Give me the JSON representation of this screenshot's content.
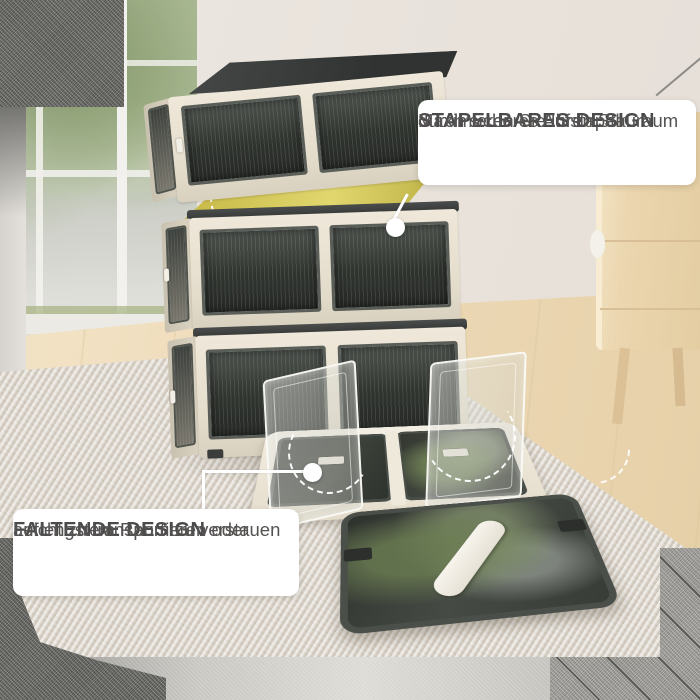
{
  "annotations": {
    "stackable": {
      "title": "STAPELBARES DESIGN",
      "line1": "Maximieren Sie Ihren Stauraum",
      "line2": "durch sicheres Aufstapeln"
    },
    "foldable": {
      "title": "FALTENDE DESIGN",
      "line1": "Leicht zu transportieren oder",
      "line2": "auf engstem Raum zu verstauen"
    }
  },
  "colors": {
    "highlight_top_surface": "#c4b53e",
    "box_frame_cream": "#e7dfd0",
    "box_panel_dark": "#31342f",
    "note_background": "#ffffff",
    "note_text": "#4a4a4a",
    "callout_white": "#ffffff",
    "corner_texture_dark": "#6f6f6b",
    "corner_texture_light": "#a3a29d",
    "rug": "#dcd5cb",
    "wood_floor": "#ecd9b6",
    "cabinet_wood": "#ebd6af"
  },
  "icons": {
    "callout_dot": "filled white circle marker",
    "fold_arc": "white dashed arc showing fold direction"
  }
}
